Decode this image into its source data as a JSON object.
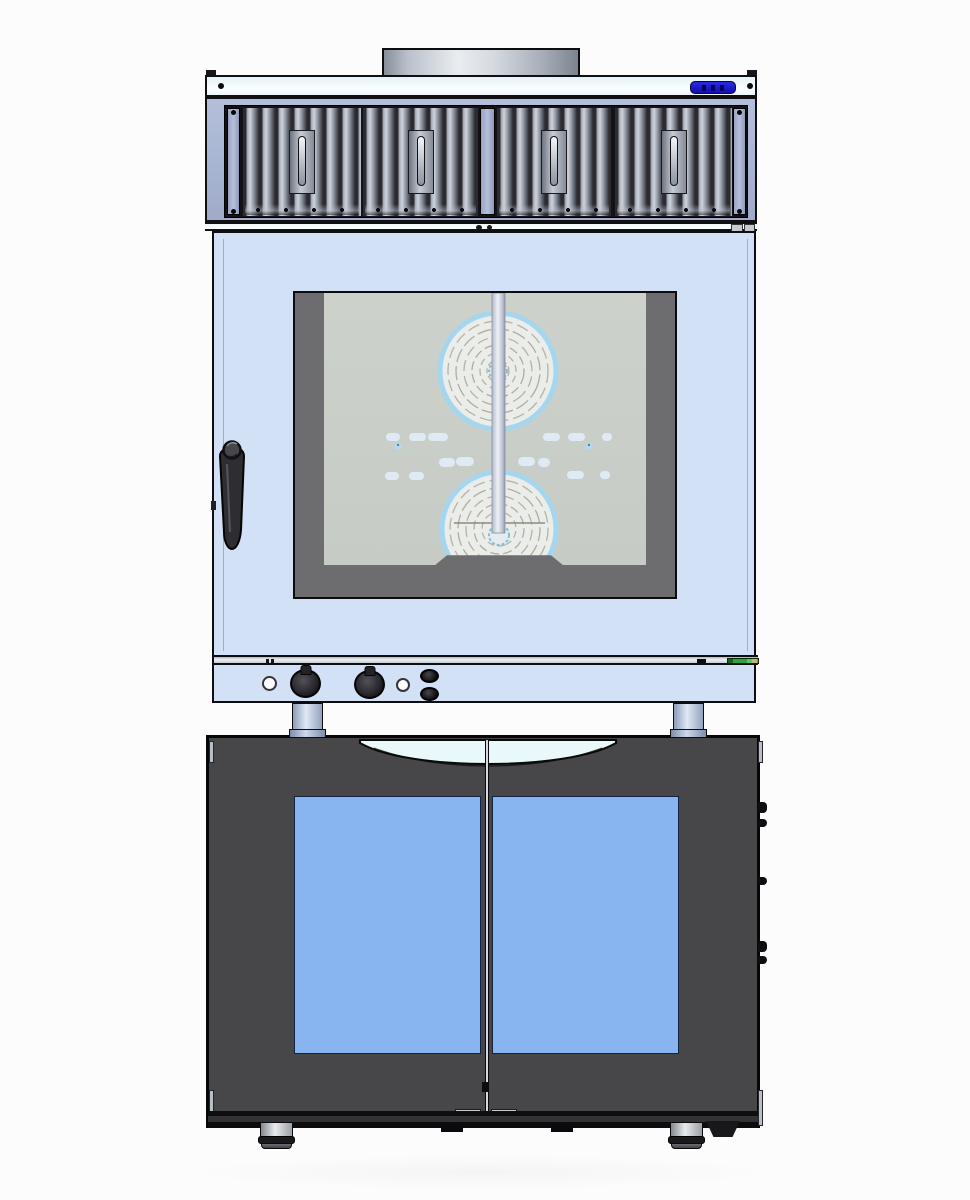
{
  "scene": {
    "subject": "combi steam oven with condensation hood stacked on a two-door proofer stand cabinet, front elevation CAD rendering",
    "visible_text": []
  },
  "hood": {
    "filter_panel_count": 4,
    "filter_handle_count": 4,
    "display": {
      "value": "",
      "style": "blue-lcd",
      "legible": false
    },
    "screw_count": 2
  },
  "oven": {
    "knob_count": 2,
    "indicator_light_count": 2,
    "oval_button_count": 2,
    "fan_guards_visible": 2,
    "door_handle_count": 1
  },
  "cabinet": {
    "door_count": 2,
    "glass_panel_count": 2,
    "foot_count": 2,
    "side_hinge_count": 5
  },
  "colors": {
    "background": "#fcfcfd",
    "oven_body": "#d3e1f7",
    "hood_frame": "#a9b6d3",
    "hood_band": "#f4fafd",
    "filter_cavity": "#131317",
    "filter_slat": "#9aa0aa",
    "window_frame": "#6d6d70",
    "glass_interior": "#c9cfc8",
    "fan_disc": "#eaede9",
    "fan_rim_blue": "#a6d6ee",
    "steam_pill": "#dfeaf5",
    "cabinet_body": "#47474a",
    "cabinet_glass": "#88b5ef",
    "handle_scoop": "#e9f8f8",
    "display_blue": "#1818c8",
    "label_green": "#2fa344",
    "knob_black": "#1a1a1c",
    "pipe_steel": "#d6dbe1",
    "leg_steel_blue": "#ccd8ec"
  }
}
